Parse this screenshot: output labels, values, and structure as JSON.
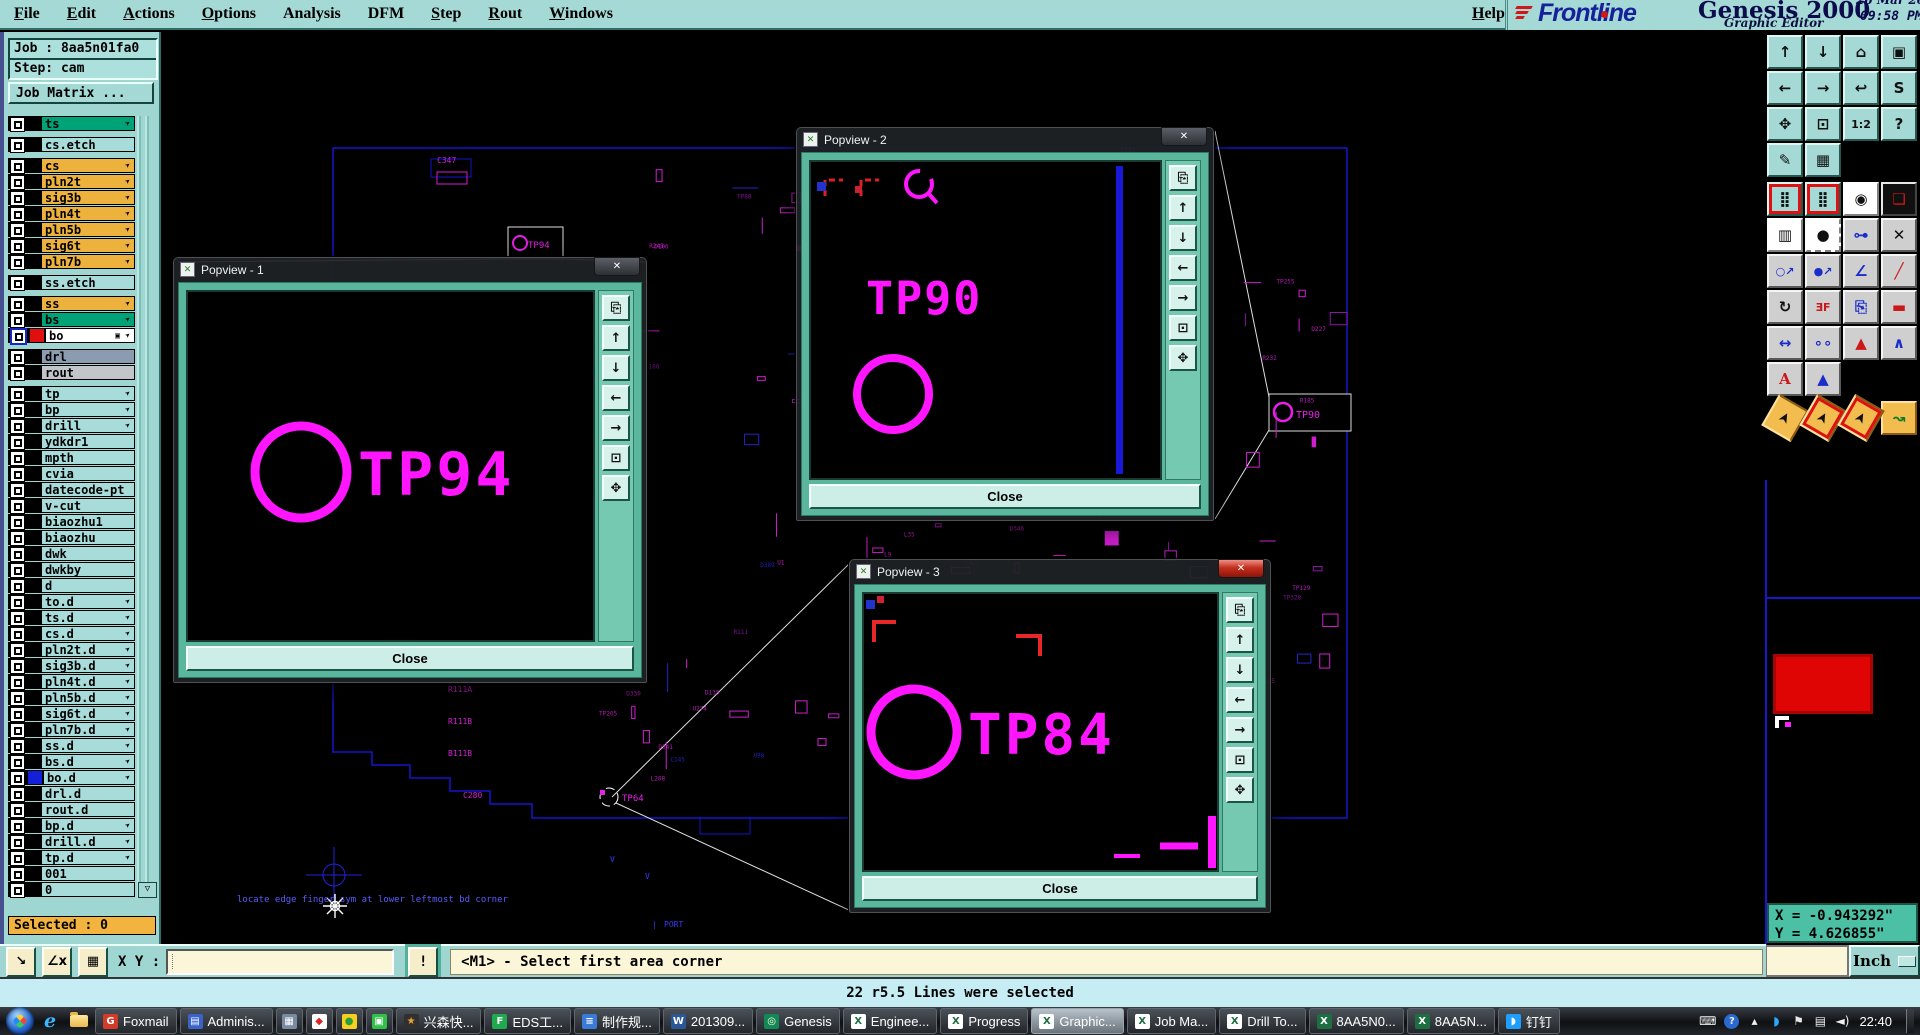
{
  "menu": {
    "items": [
      {
        "label": "File",
        "u": 0
      },
      {
        "label": "Edit",
        "u": 0
      },
      {
        "label": "Actions",
        "u": 0
      },
      {
        "label": "Options",
        "u": 0
      },
      {
        "label": "Analysis",
        "u": -1
      },
      {
        "label": "DFM",
        "u": -1
      },
      {
        "label": "Step",
        "u": 0
      },
      {
        "label": "Rout",
        "u": 0
      },
      {
        "label": "Windows",
        "u": 0
      }
    ],
    "help": {
      "label": "Help",
      "u": 0
    }
  },
  "logo": {
    "brand": "Frontline",
    "product": "Genesis 2000",
    "edition": "Graphic Editor",
    "date": "26 Mar 2014",
    "time": "09:58 PM"
  },
  "job": {
    "job_label": "Job : 8aa5n01fa0",
    "step_label": "Step: cam",
    "matrix_button": "Job Matrix ...",
    "selected_label": "Selected : 0"
  },
  "layers": [
    {
      "n": "ts",
      "c": "green",
      "h": true
    },
    {
      "n": "cs.etch",
      "c": "lt",
      "gap": true
    },
    {
      "n": "cs",
      "c": "gold",
      "h": true,
      "gap": true
    },
    {
      "n": "pln2t",
      "c": "gold",
      "h": true
    },
    {
      "n": "sig3b",
      "c": "gold",
      "h": true
    },
    {
      "n": "pln4t",
      "c": "gold",
      "h": true
    },
    {
      "n": "pln5b",
      "c": "gold",
      "h": true
    },
    {
      "n": "sig6t",
      "c": "gold",
      "h": true
    },
    {
      "n": "pln7b",
      "c": "gold",
      "h": true
    },
    {
      "n": "ss.etch",
      "c": "lt",
      "gap": true
    },
    {
      "n": "ss",
      "c": "gold",
      "h": true,
      "gap": true
    },
    {
      "n": "bs",
      "c": "green",
      "h": true
    },
    {
      "n": "bo",
      "c": "white",
      "h": true,
      "sel": true,
      "chip": "red",
      "extra": true
    },
    {
      "n": "drl",
      "c": "drl",
      "gap": true
    },
    {
      "n": "rout",
      "c": "rout"
    },
    {
      "n": "tp",
      "c": "lt",
      "h": true,
      "gap": true
    },
    {
      "n": "bp",
      "c": "lt",
      "h": true
    },
    {
      "n": "drill",
      "c": "lt",
      "h": true
    },
    {
      "n": "ydkdr1",
      "c": "lt"
    },
    {
      "n": "mpth",
      "c": "lt"
    },
    {
      "n": "cvia",
      "c": "lt"
    },
    {
      "n": "datecode-pt",
      "c": "lt"
    },
    {
      "n": "v-cut",
      "c": "lt"
    },
    {
      "n": "biaozhu1",
      "c": "lt"
    },
    {
      "n": "biaozhu",
      "c": "lt"
    },
    {
      "n": "dwk",
      "c": "lt"
    },
    {
      "n": "dwkby",
      "c": "lt"
    },
    {
      "n": "d",
      "c": "lt"
    },
    {
      "n": "to.d",
      "c": "lt",
      "h": true
    },
    {
      "n": "ts.d",
      "c": "lt",
      "h": true
    },
    {
      "n": "cs.d",
      "c": "lt",
      "h": true
    },
    {
      "n": "pln2t.d",
      "c": "lt",
      "h": true
    },
    {
      "n": "sig3b.d",
      "c": "lt",
      "h": true
    },
    {
      "n": "pln4t.d",
      "c": "lt",
      "h": true
    },
    {
      "n": "pln5b.d",
      "c": "lt",
      "h": true
    },
    {
      "n": "sig6t.d",
      "c": "lt",
      "h": true
    },
    {
      "n": "pln7b.d",
      "c": "lt",
      "h": true
    },
    {
      "n": "ss.d",
      "c": "lt",
      "h": true
    },
    {
      "n": "bs.d",
      "c": "lt",
      "h": true
    },
    {
      "n": "bo.d",
      "c": "lt",
      "h": true,
      "chip": "blue"
    },
    {
      "n": "drl.d",
      "c": "lt"
    },
    {
      "n": "rout.d",
      "c": "lt"
    },
    {
      "n": "bp.d",
      "c": "lt",
      "h": true
    },
    {
      "n": "drill.d",
      "c": "lt",
      "h": true
    },
    {
      "n": "tp.d",
      "c": "lt",
      "h": true
    },
    {
      "n": "001",
      "c": "lt"
    },
    {
      "n": "0",
      "c": "lt"
    }
  ],
  "statusbar": {
    "xy_label": "X Y :",
    "xy_value": "",
    "alert": "!",
    "prompt": "<M1> - Select first area corner",
    "buttons": [
      {
        "name": "zoom-corner-button",
        "glyph": "↘"
      },
      {
        "name": "measure-angle-button",
        "glyph": "∠x"
      },
      {
        "name": "grid-table-button",
        "glyph": "▦"
      }
    ]
  },
  "message_bar": {
    "text": "22 r5.5 Lines were selected"
  },
  "coords": {
    "x_text": "X = -0.943292\"",
    "y_text": "Y = 4.626855\"",
    "units": "Inch"
  },
  "popups": [
    {
      "title": "Popview - 1",
      "tp_label": "TP94",
      "close_label": "Close",
      "close_glyph": "✕"
    },
    {
      "title": "Popview - 2",
      "tp_label": "TP90",
      "close_label": "Close",
      "close_glyph": "✕"
    },
    {
      "title": "Popview - 3",
      "tp_label": "TP84",
      "close_label": "Close",
      "close_glyph": "✕"
    }
  ],
  "popup_strip": [
    {
      "name": "detach-view-icon",
      "glyph": "⎘"
    },
    {
      "name": "pan-up-icon",
      "glyph": "↑"
    },
    {
      "name": "pan-down-icon",
      "glyph": "↓"
    },
    {
      "name": "pan-left-icon",
      "glyph": "←"
    },
    {
      "name": "pan-right-icon",
      "glyph": "→"
    },
    {
      "name": "zoom-in-icon",
      "glyph": "⊡"
    },
    {
      "name": "zoom-out-icon",
      "glyph": "✥"
    }
  ],
  "right_toolbar": [
    {
      "g": "↑",
      "c": "a",
      "n": "pan-up"
    },
    {
      "g": "↓",
      "c": "a",
      "n": "pan-down"
    },
    {
      "g": "⌂",
      "c": "a",
      "n": "zoom-home"
    },
    {
      "g": "▣",
      "c": "a",
      "n": "view-window"
    },
    {
      "g": "←",
      "c": "a",
      "n": "pan-left"
    },
    {
      "g": "→",
      "c": "a",
      "n": "pan-right"
    },
    {
      "g": "↩",
      "c": "a",
      "n": "previous-view"
    },
    {
      "g": "S",
      "c": "a",
      "n": "serpentine-route"
    },
    {
      "g": "✥",
      "c": "a",
      "n": "zoom-out"
    },
    {
      "g": "⊡",
      "c": "a",
      "n": "zoom-in"
    },
    {
      "g": "1:2",
      "c": "a m-t",
      "n": "zoom-ratio"
    },
    {
      "g": "?",
      "c": "a",
      "n": "query"
    },
    {
      "g": "✎",
      "c": "a",
      "n": "setup-tools"
    },
    {
      "g": "▦",
      "c": "a",
      "n": "grid-toggle"
    },
    {
      "g": "⣿",
      "c": "a m-rb",
      "n": "net-list-a",
      "brk": true
    },
    {
      "g": "⣿",
      "c": "a m-rb",
      "n": "net-list-b"
    },
    {
      "g": "◉",
      "c": "w",
      "n": "copy-to-layer"
    },
    {
      "g": "❏",
      "c": "k m-cr",
      "n": "transform-pad"
    },
    {
      "g": "▥",
      "c": "w",
      "n": "ruler-measure"
    },
    {
      "g": "●",
      "c": "w m-dash",
      "n": "select-pad"
    },
    {
      "g": "⊶",
      "c": "g m-cb",
      "n": "add-line"
    },
    {
      "g": "✕",
      "c": "g",
      "n": "delete-item"
    },
    {
      "g": "○↗",
      "c": "g m-cb m-t",
      "n": "move-point"
    },
    {
      "g": "●↗",
      "c": "g m-cb m-t",
      "n": "copy-point"
    },
    {
      "g": "∠",
      "c": "g m-cb",
      "n": "angle-tool"
    },
    {
      "g": "╱",
      "c": "g m-cr",
      "n": "slope-line"
    },
    {
      "g": "↻",
      "c": "g",
      "n": "rotate-tool"
    },
    {
      "g": "ƎF",
      "c": "g m-cr m-t",
      "n": "mirror-tool"
    },
    {
      "g": "⎘",
      "c": "g m-cb",
      "n": "duplicate-tool"
    },
    {
      "g": "▬",
      "c": "g m-cr",
      "n": "stretch-line"
    },
    {
      "g": "↔",
      "c": "g m-cb",
      "n": "measure-width"
    },
    {
      "g": "∘∘",
      "c": "g m-cb",
      "n": "overlap-circles"
    },
    {
      "g": "▲",
      "c": "g m-t1",
      "n": "triangle-fill"
    },
    {
      "g": "∧",
      "c": "g m-t2",
      "n": "triangle-outline"
    },
    {
      "g": "A",
      "c": "g m-t3",
      "n": "text-tool"
    },
    {
      "g": "▲",
      "c": "g m-t4",
      "n": "triangle-marked"
    },
    {
      "g": "➤",
      "c": "o m-arr",
      "n": "select-cursor",
      "brk": true
    },
    {
      "g": "➤",
      "c": "o m-arr m-rb",
      "n": "select-inside"
    },
    {
      "g": "➤",
      "c": "o m-arr m-rb",
      "n": "select-touching"
    },
    {
      "g": "↝",
      "c": "o m-cg",
      "n": "select-net"
    }
  ],
  "board": {
    "labels": [
      {
        "t": "locate edge finger sym at lower leftmost bd corner",
        "x": 237,
        "y": 902,
        "c": "#5b5bff",
        "s": 9
      },
      {
        "t": "PORT",
        "x": 664,
        "y": 927,
        "c": "#3a3aff",
        "s": 8
      },
      {
        "t": "|",
        "x": 652,
        "y": 927,
        "c": "#3a3aff",
        "s": 8
      },
      {
        "t": "V",
        "x": 610,
        "y": 862,
        "c": "#3a3aff",
        "s": 8
      },
      {
        "t": "V",
        "x": 645,
        "y": 879,
        "c": "#3a3aff",
        "s": 8
      },
      {
        "t": "C347",
        "x": 437,
        "y": 163,
        "c": "#d81cd8",
        "s": 8
      },
      {
        "t": "R111A",
        "x": 448,
        "y": 692,
        "c": "#d81cd8",
        "s": 8
      },
      {
        "t": "R111B",
        "x": 448,
        "y": 724,
        "c": "#d81cd8",
        "s": 8
      },
      {
        "t": "B111B",
        "x": 448,
        "y": 756,
        "c": "#d81cd8",
        "s": 8
      },
      {
        "t": "C280",
        "x": 463,
        "y": 798,
        "c": "#d81cd8",
        "s": 8
      },
      {
        "t": "TP64",
        "x": 622,
        "y": 801,
        "c": "#e820e8",
        "s": 9
      },
      {
        "t": "TP94",
        "x": 528,
        "y": 248,
        "c": "#e820e8",
        "s": 9
      },
      {
        "t": "TP90",
        "x": 1296,
        "y": 418,
        "c": "#e820e8",
        "s": 10
      }
    ],
    "scatter": {
      "seed": 42,
      "colors": [
        "#cf1fcf",
        "#8e14a8",
        "#2525c8"
      ],
      "prefixes": [
        "C",
        "R",
        "U",
        "L",
        "TP",
        "D"
      ],
      "regions": [
        {
          "x": 640,
          "y": 145,
          "w": 360,
          "h": 670,
          "n": 72
        },
        {
          "x": 1000,
          "y": 150,
          "w": 128,
          "h": 420,
          "n": 30
        },
        {
          "x": 1130,
          "y": 540,
          "w": 210,
          "h": 150,
          "n": 22
        },
        {
          "x": 520,
          "y": 300,
          "w": 118,
          "h": 420,
          "n": 18
        },
        {
          "x": 1240,
          "y": 255,
          "w": 100,
          "h": 210,
          "n": 12
        }
      ]
    }
  },
  "taskbar": {
    "buttons": [
      {
        "label": "Foxmail",
        "name": "task-foxmail",
        "icon": {
          "bg": "#d23b2a",
          "ch": "G",
          "fg": "#fff"
        }
      },
      {
        "label": "Adminis...",
        "name": "task-administrator",
        "icon": {
          "bg": "#3a62c8",
          "ch": "▤",
          "fg": "#fff"
        }
      },
      {
        "label": "",
        "small": true,
        "name": "task-calculator",
        "icon": {
          "bg": "#7a8aa0",
          "ch": "▦",
          "fg": "#fff"
        }
      },
      {
        "label": "",
        "small": true,
        "name": "task-stock-app",
        "icon": {
          "bg": "#ffffff",
          "ch": "◆",
          "fg": "#d22"
        }
      },
      {
        "label": "",
        "small": true,
        "name": "task-music-app",
        "icon": {
          "bg": "#f5d020",
          "ch": "●",
          "fg": "#2aa03a"
        }
      },
      {
        "label": "",
        "small": true,
        "name": "task-video-app",
        "icon": {
          "bg": "#32c04a",
          "ch": "▣",
          "fg": "#fff"
        }
      },
      {
        "label": "兴森快...",
        "name": "task-xingsen",
        "icon": {
          "bg": "#303030",
          "ch": "★",
          "fg": "#f0a030"
        }
      },
      {
        "label": "EDS工...",
        "name": "task-eds",
        "icon": {
          "bg": "#1faa50",
          "ch": "F",
          "fg": "#fff"
        }
      },
      {
        "label": "制作规...",
        "name": "task-spec-doc",
        "icon": {
          "bg": "#3a7ad8",
          "ch": "≡",
          "fg": "#fff"
        }
      },
      {
        "label": "201309...",
        "name": "task-word-doc",
        "icon": {
          "bg": "#2b5797",
          "ch": "W",
          "fg": "#fff"
        }
      },
      {
        "label": "Genesis",
        "name": "task-genesis",
        "icon": {
          "bg": "#118855",
          "ch": "◎",
          "fg": "#ffd"
        }
      },
      {
        "label": "Enginee...",
        "name": "task-excel-engineer",
        "icon": {
          "bg": "#ffffff",
          "ch": "X",
          "fg": "#1d6f42"
        }
      },
      {
        "label": "Progress",
        "name": "task-excel-progress",
        "icon": {
          "bg": "#ffffff",
          "ch": "X",
          "fg": "#1d6f42"
        }
      },
      {
        "label": "Graphic...",
        "name": "task-graphic-editor",
        "active": true,
        "icon": {
          "bg": "#ffffff",
          "ch": "X",
          "fg": "#1d6f42"
        }
      },
      {
        "label": "Job Ma...",
        "name": "task-job-manager",
        "icon": {
          "bg": "#ffffff",
          "ch": "X",
          "fg": "#1d6f42"
        }
      },
      {
        "label": "Drill To...",
        "name": "task-drill-tool",
        "icon": {
          "bg": "#ffffff",
          "ch": "X",
          "fg": "#1d6f42"
        }
      },
      {
        "label": "8AA5N0...",
        "name": "task-8aa5n0",
        "icon": {
          "bg": "#1d6f42",
          "ch": "X",
          "fg": "#fff"
        }
      },
      {
        "label": "8AA5N...",
        "name": "task-8aa5n",
        "icon": {
          "bg": "#1d6f42",
          "ch": "X",
          "fg": "#fff"
        }
      },
      {
        "label": "钉钉",
        "name": "task-dingtalk",
        "icon": {
          "bg": "#1e9fff",
          "ch": "◗",
          "fg": "#fff"
        }
      }
    ],
    "tray": [
      {
        "name": "keyboard-tray-icon",
        "ch": "⌨",
        "cls": ""
      },
      {
        "name": "help-tray-icon",
        "ch": "?",
        "cls": "badge"
      },
      {
        "name": "show-hidden-icons",
        "ch": "▴",
        "cls": ""
      },
      {
        "name": "dingtalk-tray-icon",
        "ch": "◗",
        "cls": "",
        "color": "#2aa8ff"
      },
      {
        "name": "action-center-icon",
        "ch": "⚑",
        "cls": "",
        "color": "#e8e8e8"
      },
      {
        "name": "network-tray-icon",
        "ch": "▤",
        "cls": ""
      },
      {
        "name": "volume-tray-icon",
        "ch": "◄)",
        "cls": ""
      }
    ],
    "clock": "22:40"
  }
}
